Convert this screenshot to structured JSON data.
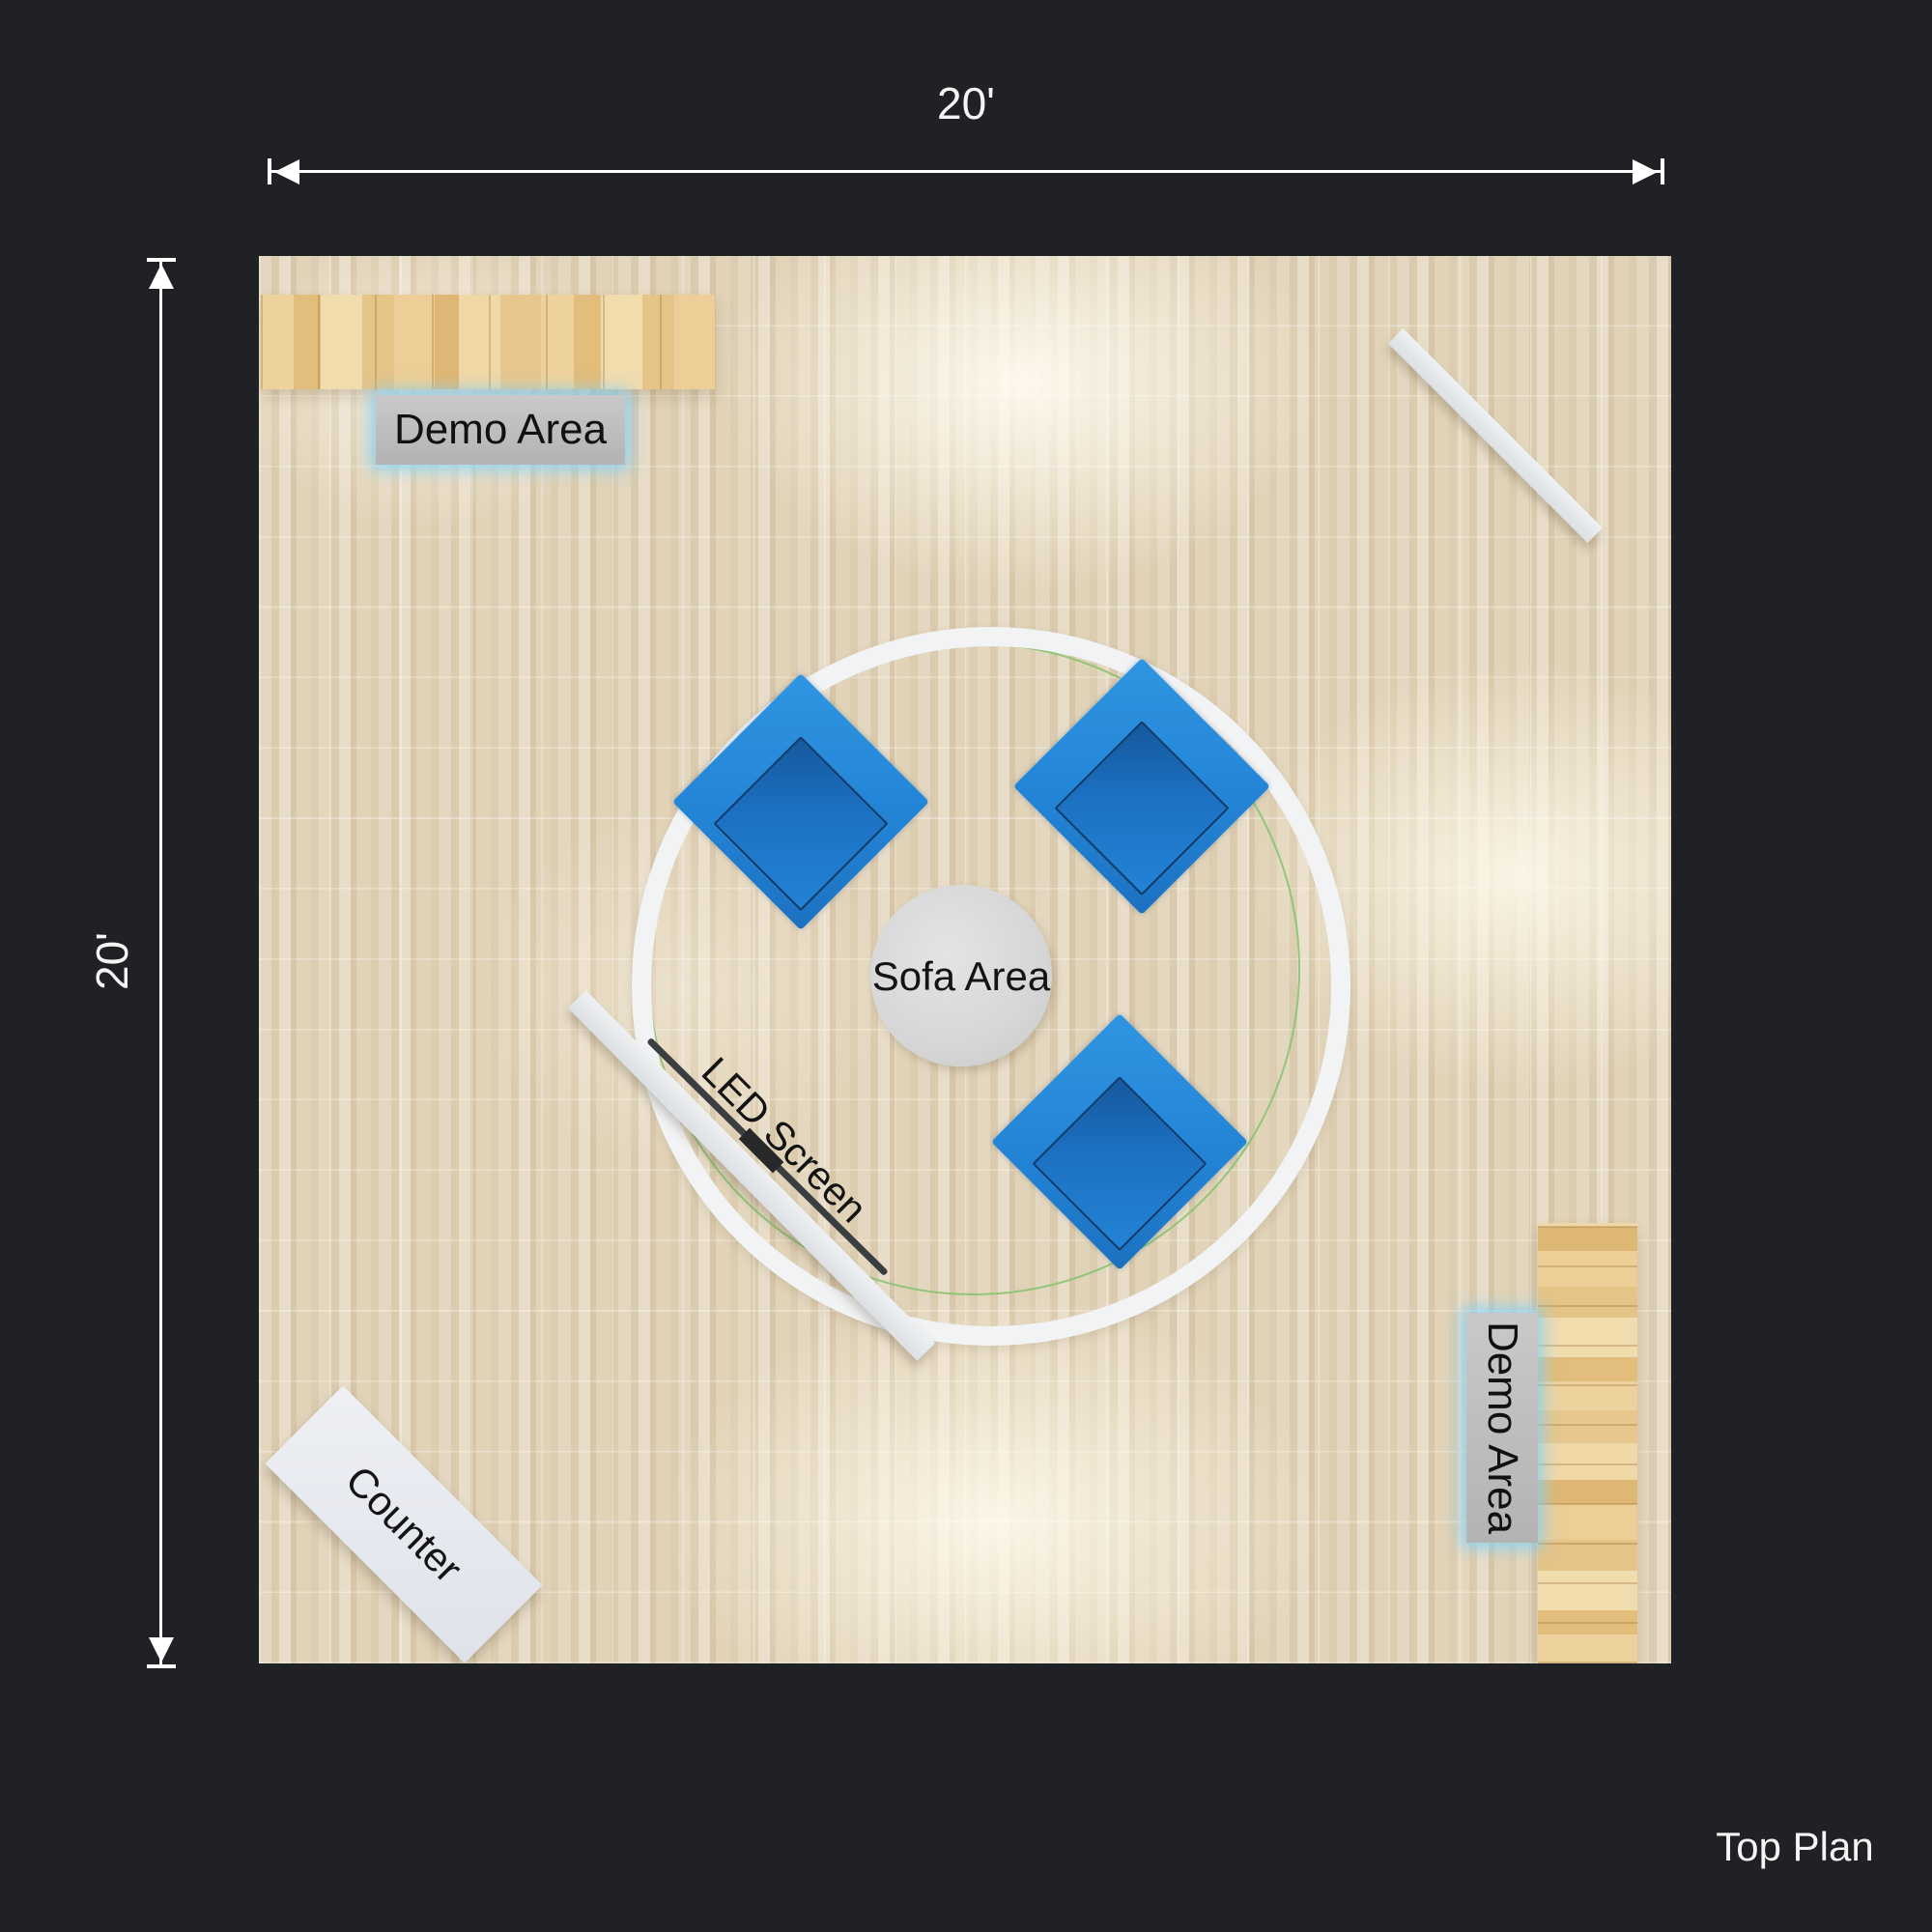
{
  "title": "Top Plan",
  "dimensions": {
    "width_label": "20'",
    "height_label": "20'"
  },
  "areas": {
    "demo_top": {
      "label": "Demo Area"
    },
    "demo_right": {
      "label": "Demo Area"
    },
    "sofa": {
      "label": "Sofa Area"
    },
    "led_screen": {
      "label": "LED Screen"
    },
    "counter": {
      "label": "Counter"
    }
  },
  "colors": {
    "background": "#202124",
    "floor_wood": "#decfb4",
    "counter_wood": "#e8c98e",
    "sofa_blue": "#2384d6",
    "sofa_seat_blue": "#1d71c3",
    "sofa_outline_navy": "#123a67",
    "label_gray": "#c0c0c0",
    "glow_blue": "#7dd0fa",
    "ring_white": "#f2f3f5",
    "ring_green": "#82c36e",
    "furniture_white": "#e9ebee",
    "annotation_white": "#f4f4f4"
  }
}
